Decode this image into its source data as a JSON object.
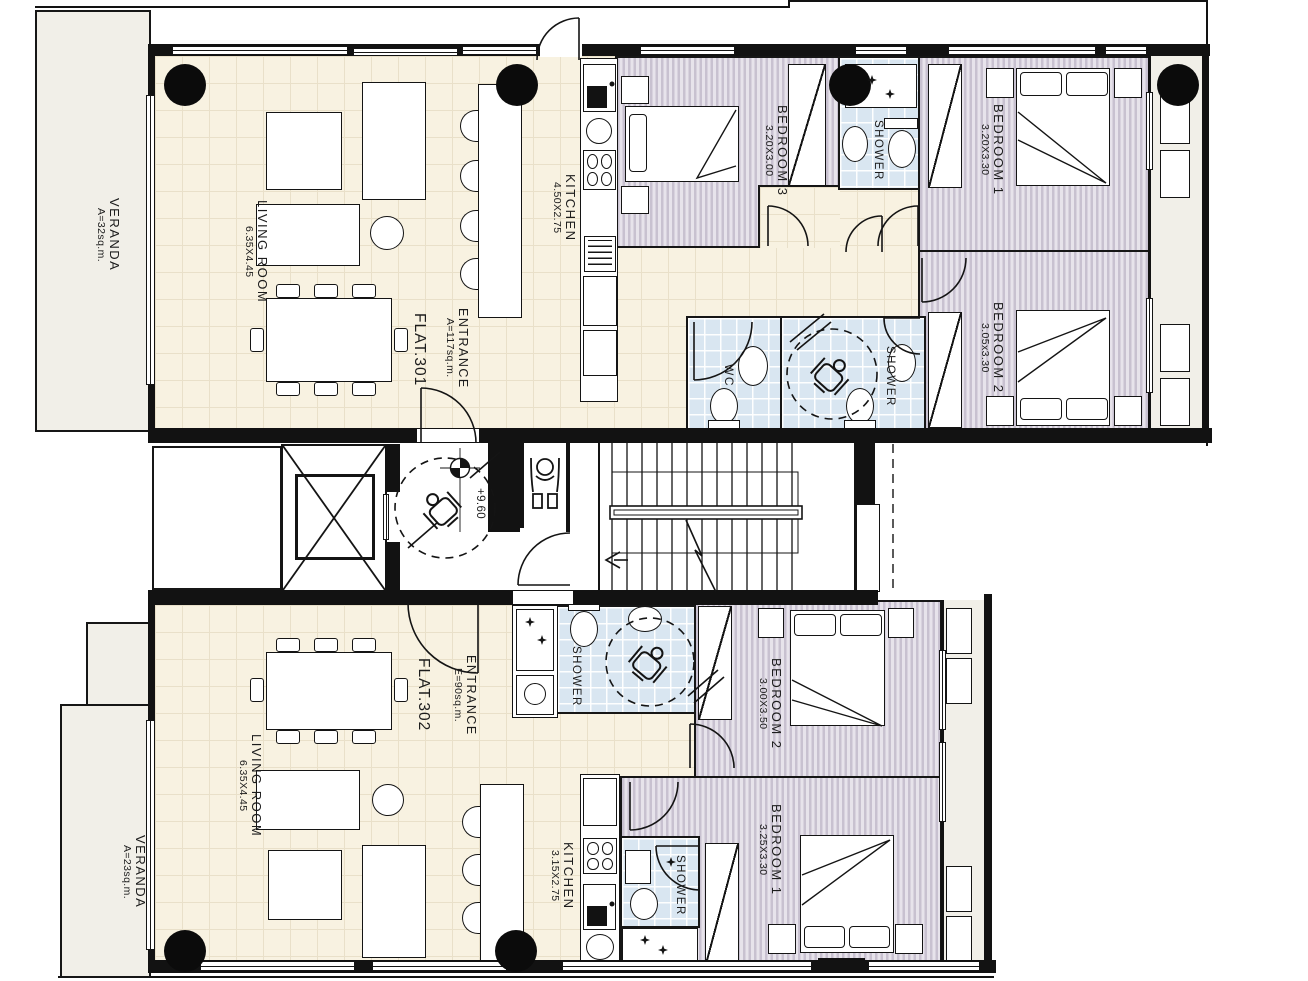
{
  "plan": {
    "title": "Third floor plan - two flats",
    "core": {
      "level": "+9.60"
    },
    "f301": {
      "flat": "FLAT.301",
      "entrance": {
        "label": "ENTRANCE",
        "area": "A=117sq.m."
      },
      "veranda": {
        "label": "VERANDA",
        "area": "A=32sq.m."
      },
      "living": {
        "label": "LIVING ROOM",
        "dims": "6.35X4.45"
      },
      "kitchen": {
        "label": "KITCHEN",
        "dims": "4.50X2.75"
      },
      "bedroom3": {
        "label": "BEDROOM 3",
        "dims": "3.20X3.00"
      },
      "bedroom1": {
        "label": "BEDROOM 1",
        "dims": "3.20X3.30"
      },
      "bedroom2": {
        "label": "BEDROOM 2",
        "dims": "3.05x3.30"
      },
      "shower": {
        "label": "SHOWER"
      },
      "wc": {
        "label": "WC"
      },
      "shower_mid": {
        "label": "SHOWER"
      }
    },
    "f302": {
      "flat": "FLAT.302",
      "entrance": {
        "label": "ENTRANCE",
        "area": "E=90sq.m."
      },
      "veranda": {
        "label": "VERANDA",
        "area": "A=23sq.m."
      },
      "living": {
        "label": "LIVING ROOM",
        "dims": "6.35X4.45"
      },
      "kitchen": {
        "label": "KITCHEN",
        "dims": "3.15X2.75"
      },
      "bedroom2": {
        "label": "BEDROOM 2",
        "dims": "3.00X3.50"
      },
      "bedroom1": {
        "label": "BEDROOM 1",
        "dims": "3.25X3.30"
      },
      "shower": {
        "label": "SHOWER"
      },
      "shower_small": {
        "label": "SHOWER"
      }
    },
    "colors": {
      "bedroom_stripe": "#c8c1d0",
      "bathroom_tile": "#d9e6f1",
      "living_tile": "#f8f2e1",
      "veranda": "#f1efe8",
      "wall": "#121212"
    }
  }
}
